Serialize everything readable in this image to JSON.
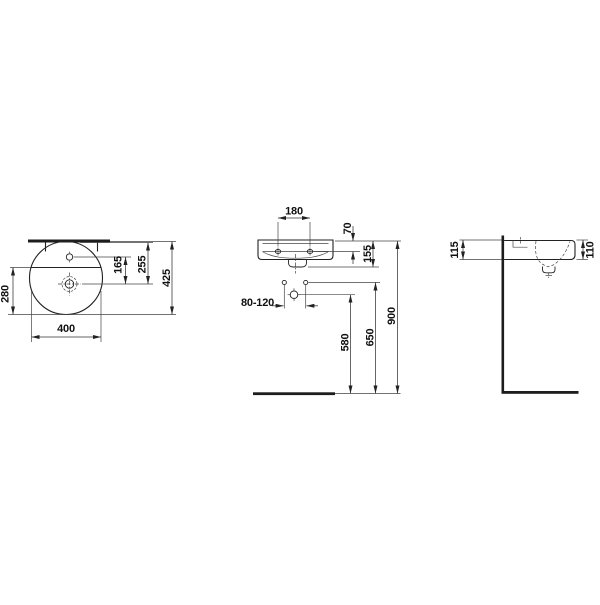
{
  "drawing": {
    "type": "technical-installation-drawing",
    "subject": "round-countertop-washbasin-three-views",
    "background_color": "#ffffff",
    "line_color": "#222222",
    "top_view": {
      "width_label": "400",
      "left_depth_label": "280",
      "tap_to_drain_label": "165",
      "wall_to_drain_label": "255",
      "total_depth_label": "425"
    },
    "front_view": {
      "tap_hole_spacing_label": "180",
      "rim_to_tapledge_label": "70",
      "body_height_label": "155",
      "fixing_hole_range_label": "80-120",
      "drain_outlet_height_label": "580",
      "fixing_holes_height_label": "650",
      "rim_height_label": "900"
    },
    "side_view": {
      "back_edge_height_label": "115",
      "front_edge_height_label": "110"
    }
  }
}
